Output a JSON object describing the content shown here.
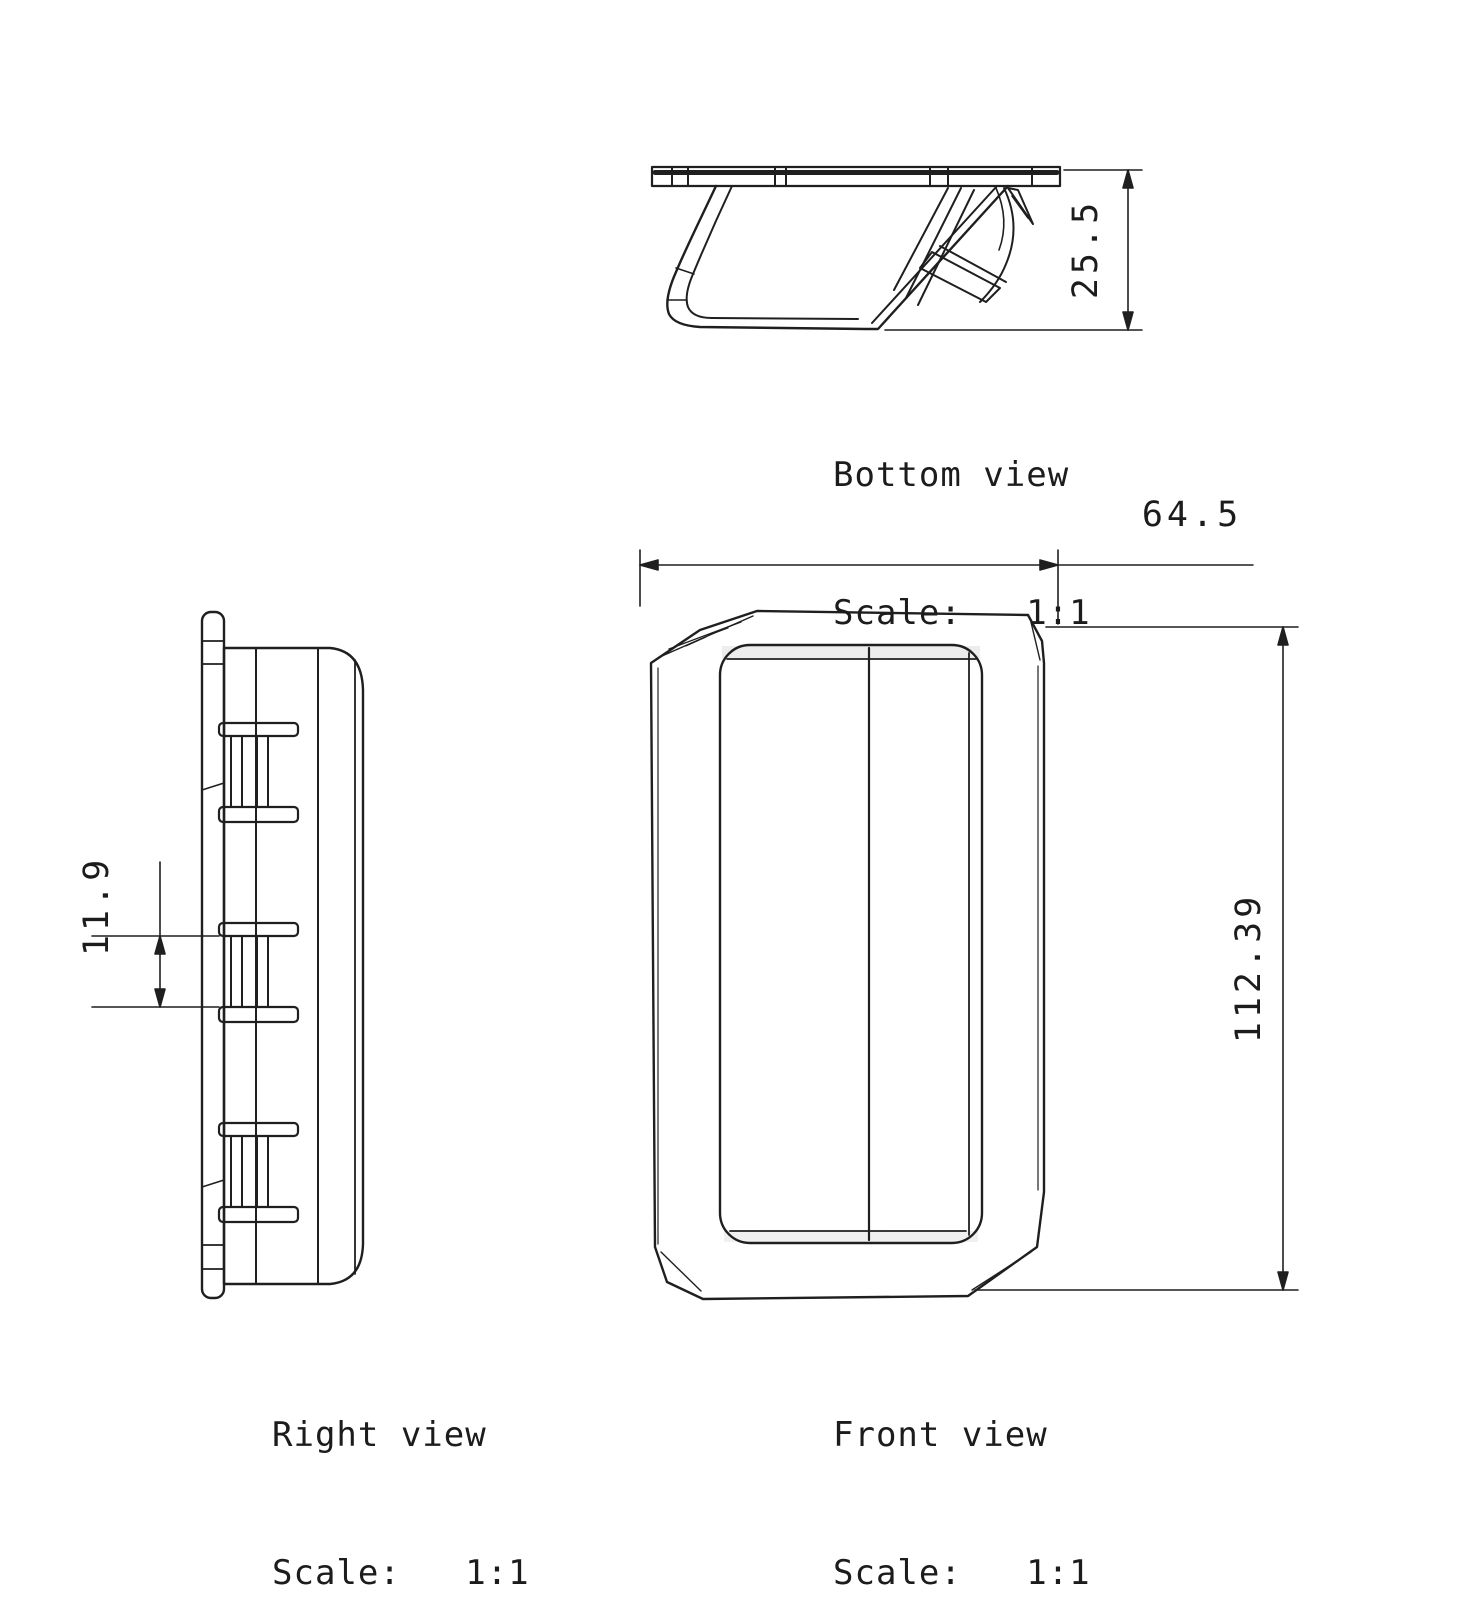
{
  "page": {
    "background": "#ffffff",
    "line_color": "#1f1f1f"
  },
  "views": {
    "bottom": {
      "title": "Bottom view",
      "scale": "Scale:   1:1",
      "dim_depth": "25.5"
    },
    "right": {
      "title": "Right view",
      "scale": "Scale:   1:1",
      "dim_clip_height": "11.9"
    },
    "front": {
      "title": "Front view",
      "scale": "Scale:   1:1",
      "dim_width": "64.5",
      "dim_height": "112.39"
    }
  }
}
